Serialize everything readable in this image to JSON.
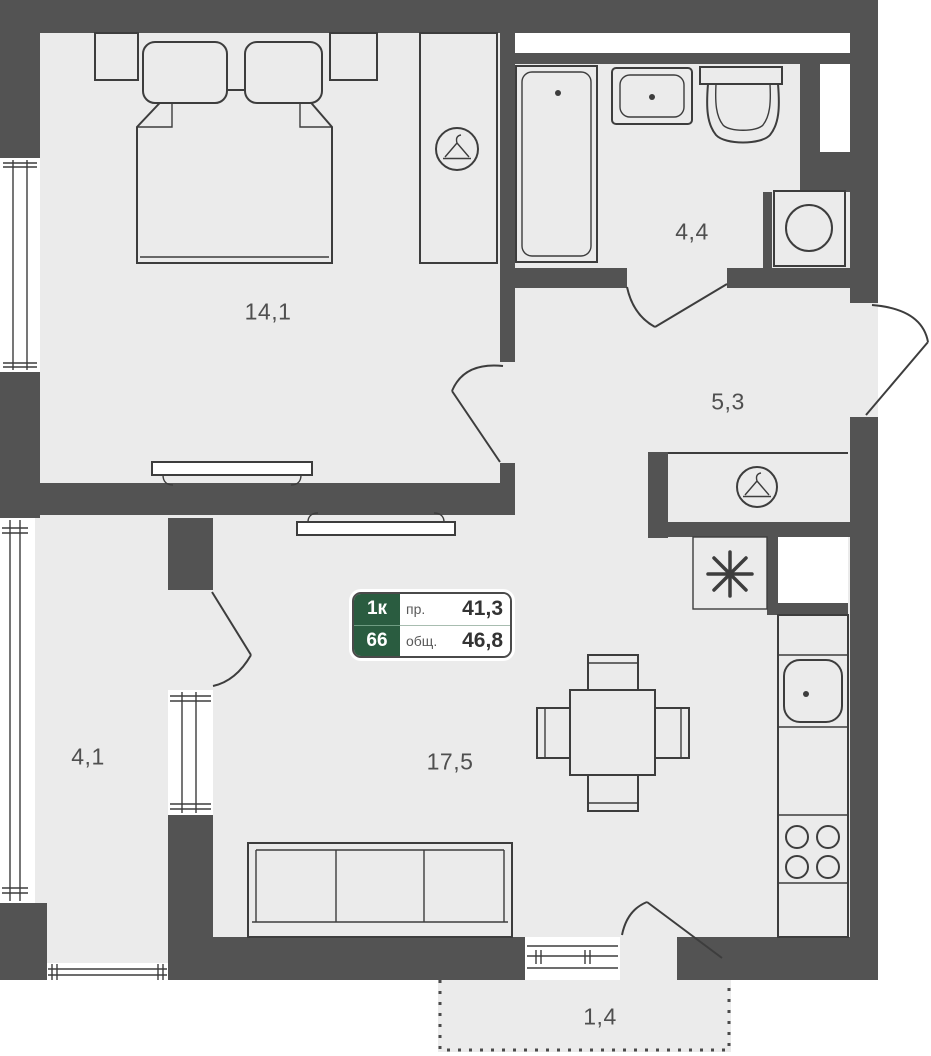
{
  "colors": {
    "wall": "#535353",
    "floor": "#ebebeb",
    "line": "#3d3d3d",
    "label": "#4f4f4f",
    "badge_green": "#2a5c40",
    "badge_divider": "#6f9c82",
    "badge_label_gray": "#5a5a5a",
    "badge_text_dark": "#333333"
  },
  "badge": {
    "rooms_count": "1к",
    "unit_number": "66",
    "living_area_label": "пр.",
    "living_area_value": "41,3",
    "total_area_label": "общ.",
    "total_area_value": "46,8"
  },
  "rooms": [
    {
      "key": "bedroom",
      "area": "14,1"
    },
    {
      "key": "bathroom",
      "area": "4,4"
    },
    {
      "key": "hallway",
      "area": "5,3"
    },
    {
      "key": "loggia",
      "area": "4,1"
    },
    {
      "key": "living-kitchen",
      "area": "17,5"
    },
    {
      "key": "balcony",
      "area": "1,4"
    }
  ],
  "icons": {
    "bedroom_wardrobe": "hanger-in-circle",
    "hall_wardrobe": "hanger-in-circle",
    "fridge_spot": "✳"
  }
}
